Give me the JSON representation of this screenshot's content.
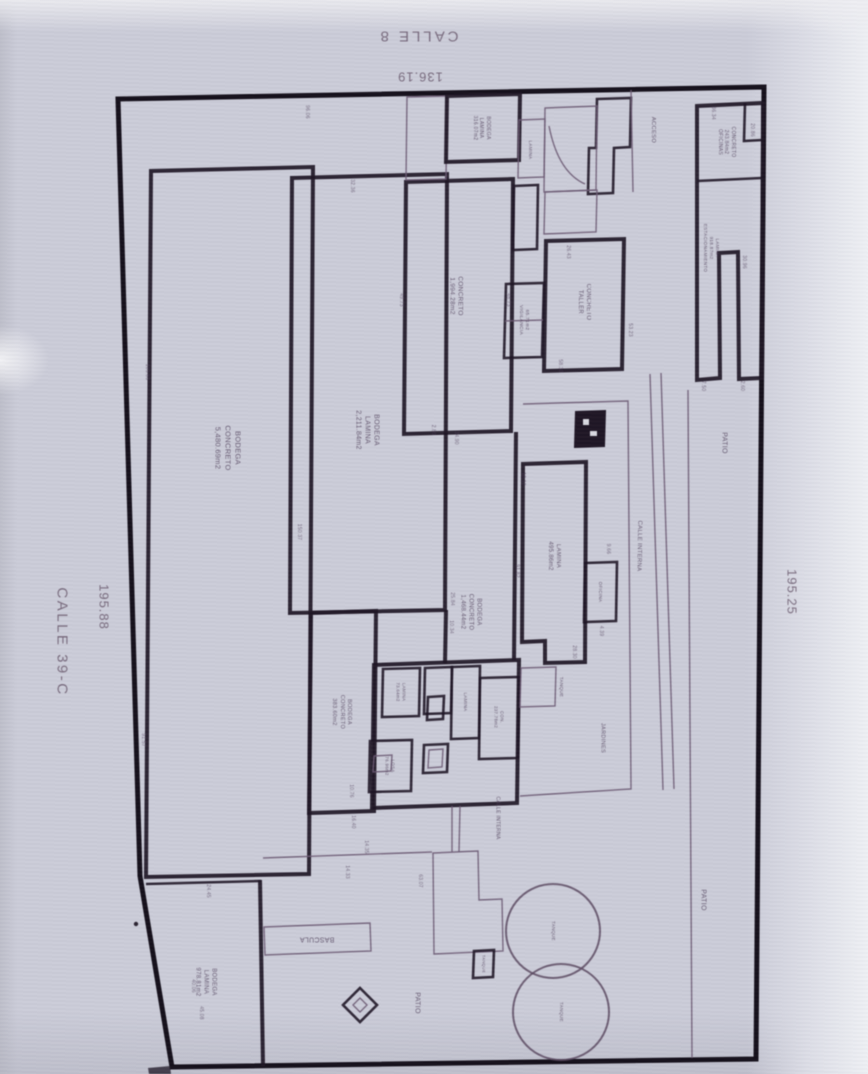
{
  "streets": {
    "top_name": "CALLE 8",
    "top_dim": "136.19",
    "left_name": "CALLE 39-C",
    "left_dim": "195.88",
    "right_dim": "195.25"
  },
  "colors": {
    "boundary": "#130e19",
    "wall": "#1d1423",
    "thin": "#6d5b74",
    "ink": "#4f3f5a"
  },
  "plan_labels": [
    {
      "name": "label-bodega-concreto-main",
      "text": "BODEGA\nCONCRETO\n5,480.69m2",
      "x": 228,
      "y": 448,
      "rot": 90,
      "size": 7.5
    },
    {
      "name": "label-bodega-lamina-main",
      "text": "BODEGA\nLAMINA\n2,211.84m2",
      "x": 367,
      "y": 430,
      "rot": 90,
      "size": 7
    },
    {
      "name": "label-concreto-1994",
      "text": "CONCRETO\n1,994.28m2",
      "x": 455,
      "y": 296,
      "rot": 90,
      "size": 6.5
    },
    {
      "name": "label-concreto-taller",
      "text": "CONCRETO\nTALLER",
      "x": 583,
      "y": 302,
      "rot": 90,
      "size": 6
    },
    {
      "name": "label-vigilancia",
      "text": "65.71m2\nVIGILANCIA",
      "x": 523,
      "y": 320,
      "rot": 90,
      "size": 4.8
    },
    {
      "name": "label-bodega-lamina-316",
      "text": "BODEGA\nLAMINA\n316.07m2",
      "x": 481,
      "y": 128,
      "rot": 90,
      "size": 5
    },
    {
      "name": "label-lamina-sm-top",
      "text": "LAMINA",
      "x": 530,
      "y": 150,
      "rot": 90,
      "size": 4.6
    },
    {
      "name": "label-concreto-oficinas",
      "text": "CONCRETO\n243.84m2\nOFICINAS",
      "x": 726,
      "y": 142,
      "rot": 90,
      "size": 5
    },
    {
      "name": "label-lamina-estacionamiento",
      "text": "LAMINA\n918.87m2\nESTACIONAMIENTO",
      "x": 711,
      "y": 248,
      "rot": 90,
      "size": 4.6
    },
    {
      "name": "label-acceso",
      "text": "ACCESO",
      "x": 652,
      "y": 130,
      "rot": 90,
      "size": 5.8
    },
    {
      "name": "label-patio-right",
      "text": "PATIO",
      "x": 724,
      "y": 443,
      "rot": 90,
      "size": 7
    },
    {
      "name": "label-lamina-495",
      "text": "LAMINA\n495.86m2",
      "x": 553,
      "y": 556,
      "rot": 90,
      "size": 6
    },
    {
      "name": "label-calle-interna",
      "text": "CALLE INTERNA",
      "x": 638,
      "y": 546,
      "rot": 91,
      "size": 6
    },
    {
      "name": "label-oficina",
      "text": "OFICINA",
      "x": 600,
      "y": 592,
      "rot": 90,
      "size": 4.6
    },
    {
      "name": "label-bodega-concreto-1468",
      "text": "BODEGA\nCONCRETO\n1,468.44m2",
      "x": 470,
      "y": 612,
      "rot": 90,
      "size": 6
    },
    {
      "name": "label-jardines",
      "text": "JARDINES",
      "x": 602,
      "y": 738,
      "rot": 90,
      "size": 5.6
    },
    {
      "name": "label-tanque-box",
      "text": "TANQUE",
      "x": 561,
      "y": 687,
      "rot": 90,
      "size": 4.6
    },
    {
      "name": "label-bodega-concreto-383",
      "text": "BODEGA\nCONCRETO\n383.60m2",
      "x": 341,
      "y": 712,
      "rot": 90,
      "size": 5.6
    },
    {
      "name": "label-lamina-7364",
      "text": "LAMINA\n73.64m2",
      "x": 401,
      "y": 692,
      "rot": 90,
      "size": 4.4
    },
    {
      "name": "label-lamina-room",
      "text": "LAMINA",
      "x": 465,
      "y": 702,
      "rot": 90,
      "size": 4.6
    },
    {
      "name": "label-con-23778",
      "text": "CON.\n237.78m2",
      "x": 499,
      "y": 717,
      "rot": 90,
      "size": 4.4
    },
    {
      "name": "label-losa",
      "text": "LOSA\n76.96m2",
      "x": 390,
      "y": 766,
      "rot": 90,
      "size": 4.4
    },
    {
      "name": "label-calle-interna-2",
      "text": "CALLE INTERNA",
      "x": 497,
      "y": 818,
      "rot": 90,
      "size": 5
    },
    {
      "name": "label-bascula",
      "text": "BASCULA",
      "x": 317,
      "y": 939,
      "rot": 180,
      "size": 7
    },
    {
      "name": "label-bodega-lamina-978",
      "text": "BODEGA\nLAMINA\n978.81m2",
      "x": 205,
      "y": 982,
      "rot": 90,
      "size": 6
    },
    {
      "name": "label-patio-center",
      "text": "PATIO",
      "x": 417,
      "y": 1003,
      "rot": 90,
      "size": 7
    },
    {
      "name": "label-patio-bottom-right",
      "text": "PATIO",
      "x": 703,
      "y": 900,
      "rot": 90,
      "size": 7
    },
    {
      "name": "label-tanque-small",
      "text": "TANQUE",
      "x": 484,
      "y": 964,
      "rot": 90,
      "size": 4
    },
    {
      "name": "label-tank-1",
      "text": "TANQUE",
      "x": 553,
      "y": 931,
      "rot": 90,
      "size": 4.4
    },
    {
      "name": "label-tank-2",
      "text": "TANQUE",
      "x": 561,
      "y": 1012,
      "rot": 90,
      "size": 4.4
    }
  ],
  "plan_dims": [
    {
      "t": "103.83",
      "x": 147,
      "y": 372
    },
    {
      "t": "91.57",
      "x": 143,
      "y": 740
    },
    {
      "t": "150.37",
      "x": 299,
      "y": 532
    },
    {
      "t": "96.06",
      "x": 307,
      "y": 112
    },
    {
      "t": "32.36",
      "x": 352,
      "y": 186
    },
    {
      "t": "49.73",
      "x": 401,
      "y": 300
    },
    {
      "t": "48.73",
      "x": 508,
      "y": 300
    },
    {
      "t": "2.80",
      "x": 433,
      "y": 430
    },
    {
      "t": "34.90",
      "x": 456,
      "y": 438
    },
    {
      "t": "25.84",
      "x": 452,
      "y": 599
    },
    {
      "t": "10.34",
      "x": 451,
      "y": 627
    },
    {
      "t": "91.82",
      "x": 517,
      "y": 571
    },
    {
      "t": "10.10",
      "x": 523,
      "y": 479
    },
    {
      "t": "26.43",
      "x": 568,
      "y": 252
    },
    {
      "t": "58.30",
      "x": 560,
      "y": 366
    },
    {
      "t": "53.23",
      "x": 630,
      "y": 330
    },
    {
      "t": "30.96",
      "x": 744,
      "y": 262
    },
    {
      "t": "36.34",
      "x": 713,
      "y": 113
    },
    {
      "t": "20.86",
      "x": 752,
      "y": 130
    },
    {
      "t": "7.50",
      "x": 703,
      "y": 386
    },
    {
      "t": "2.60",
      "x": 742,
      "y": 386
    },
    {
      "t": "9.66",
      "x": 608,
      "y": 549
    },
    {
      "t": "4.39",
      "x": 601,
      "y": 631
    },
    {
      "t": "28.30",
      "x": 574,
      "y": 652
    },
    {
      "t": "14.35",
      "x": 366,
      "y": 847
    },
    {
      "t": "14.33",
      "x": 347,
      "y": 872
    },
    {
      "t": "10.76",
      "x": 351,
      "y": 791
    },
    {
      "t": "16.40",
      "x": 353,
      "y": 822
    },
    {
      "t": "24.45",
      "x": 208,
      "y": 891
    },
    {
      "t": "40.06",
      "x": 193,
      "y": 986
    },
    {
      "t": "45.08",
      "x": 201,
      "y": 1013
    },
    {
      "t": "63.07",
      "x": 420,
      "y": 881
    }
  ]
}
